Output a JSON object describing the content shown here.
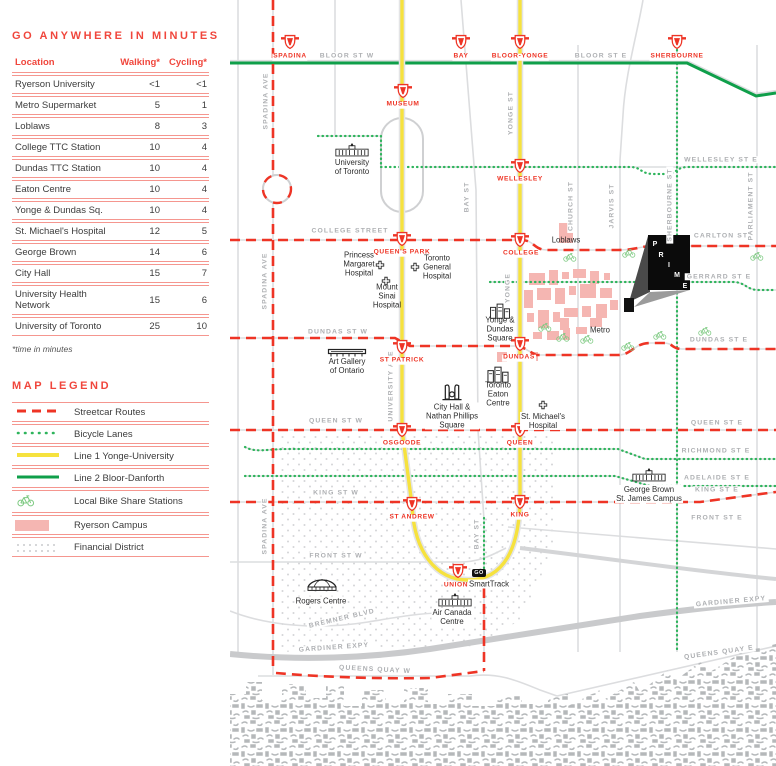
{
  "colors": {
    "red": "#ee3425",
    "table_rule_red": "#f5968f",
    "line1_yellow": "#f6e23e",
    "line2_green": "#0f9f4a",
    "bike_lane_green": "#2eb45c",
    "bike_icon_green": "#7cc980",
    "ryerson_pink": "#f5b6b2",
    "street_gray": "#dcdddf",
    "label_gray": "#aeb0b3"
  },
  "sidebar": {
    "title": "GO ANYWHERE IN MINUTES",
    "table": {
      "headers": [
        "Location",
        "Walking*",
        "Cycling*"
      ],
      "rows": [
        [
          "Ryerson University",
          "<1",
          "<1"
        ],
        [
          "Metro Supermarket",
          "5",
          "1"
        ],
        [
          "Loblaws",
          "8",
          "3"
        ],
        [
          "College TTC Station",
          "10",
          "4"
        ],
        [
          "Dundas TTC Station",
          "10",
          "4"
        ],
        [
          "Eaton Centre",
          "10",
          "4"
        ],
        [
          "Yonge & Dundas Sq.",
          "10",
          "4"
        ],
        [
          "St. Michael's Hospital",
          "12",
          "5"
        ],
        [
          "George Brown",
          "14",
          "6"
        ],
        [
          "City Hall",
          "15",
          "7"
        ],
        [
          "University Health Network",
          "15",
          "6"
        ],
        [
          "University of Toronto",
          "25",
          "10"
        ]
      ]
    },
    "footnote": "*time in minutes",
    "legend": {
      "title": "MAP LEGEND",
      "items": [
        {
          "label": "Streetcar Routes"
        },
        {
          "label": "Bicycle Lanes"
        },
        {
          "label": "Line 1 Yonge-University"
        },
        {
          "label": "Line 2 Bloor-Danforth"
        },
        {
          "label": "Local Bike Share Stations"
        },
        {
          "label": "Ryerson Campus"
        },
        {
          "label": "Financial District"
        }
      ]
    }
  },
  "map": {
    "stations": {
      "spadina": "SPADINA",
      "bay": "BAY",
      "bloor_yonge": "BLOOR-YONGE",
      "sherbourne": "SHERBOURNE",
      "museum": "MUSEUM",
      "wellesley": "WELLESLEY",
      "queens_park": "QUEEN'S PARK",
      "college": "COLLEGE",
      "st_patrick": "ST PATRICK",
      "dundas": "DUNDAS",
      "osgoode": "OSGOODE",
      "queen": "QUEEN",
      "st_andrew": "ST ANDREW",
      "king": "KING",
      "union": "UNION"
    },
    "streets": {
      "bloor_w": "BLOOR ST W",
      "bloor_e": "BLOOR ST E",
      "wellesley_e": "WELLESLEY ST E",
      "college_st": "COLLEGE STREET",
      "carlton": "CARLTON ST",
      "gerrard_e": "GERRARD ST E",
      "dundas_w": "DUNDAS ST W",
      "dundas_e": "DUNDAS ST E",
      "queen_w": "QUEEN ST W",
      "queen_e": "QUEEN ST E",
      "richmond_e": "RICHMOND ST E",
      "adelaide_e": "ADELAIDE ST E",
      "king_w": "KING ST W",
      "king_e": "KING ST E",
      "front_w": "FRONT ST W",
      "front_e": "FRONT ST E",
      "bremner": "BREMNER BLVD",
      "gardiner_w": "GARDINER EXPY",
      "gardiner_e": "GARDINER EXPY",
      "queens_quay_w": "QUEENS QUAY W",
      "queens_quay_e": "QUEENS QUAY E",
      "spadina_ave": "SPADINA AVE",
      "yonge_st": "YONGE ST",
      "yonge": "YONGE",
      "university_ave": "UNIVERSITY AVE",
      "bay_st": "BAY ST",
      "church": "CHURCH ST",
      "jarvis": "JARVIS ST",
      "sherbourne_st": "SHERBOURNE ST",
      "parliament": "PARLIAMENT ST"
    },
    "pois": {
      "uoft": "University\nof Toronto",
      "pmh": "Princess\nMargaret\nHospital",
      "tgh": "Toronto\nGeneral\nHospital",
      "msh": "Mount\nSinai\nHospital",
      "loblaws": "Loblaws",
      "metro": "Metro",
      "ydsq": "Yonge &\nDundas\nSquare",
      "ago": "Art Gallery\nof Ontario",
      "eaton": "Toronto\nEaton\nCentre",
      "cityhall": "City Hall &\nNathan Phillips\nSquare",
      "stmichael": "St. Michael's\nHospital",
      "georgebrown": "George Brown\nSt. James Campus",
      "rogers": "Rogers Centre",
      "acc": "Air Canada\nCentre"
    },
    "union_area": {
      "go": "GO",
      "smarttrack": "SmartTrack"
    },
    "prime_letters": [
      "P",
      "R",
      "I",
      "M",
      "E"
    ]
  }
}
